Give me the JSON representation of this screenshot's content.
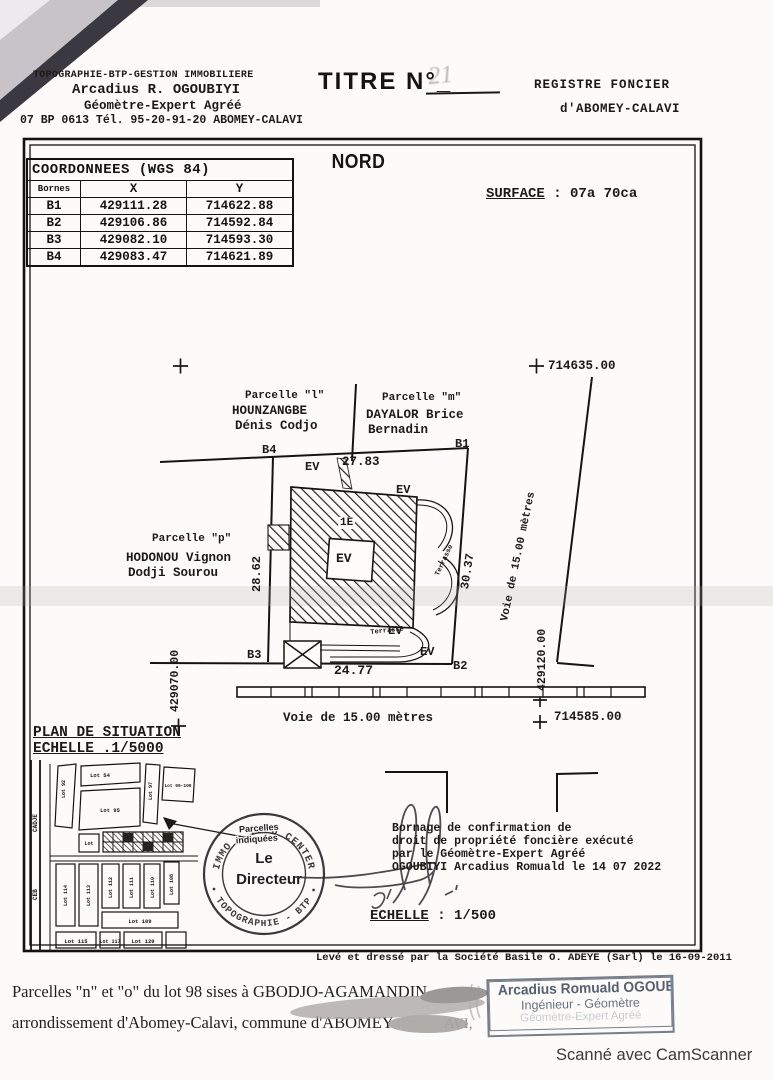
{
  "header": {
    "firm_line1": "TOPOGRAPHIE-BTP-GESTION IMMOBILIERE",
    "firm_line2": "Arcadius R. OGOUBIYI",
    "firm_line3": "Géomètre-Expert Agréé",
    "firm_line4": "07 BP 0613 Tél. 95-20-91-20 ABOMEY-CALAVI",
    "title_label": "TITRE N°_",
    "title_number": "21",
    "registre_line1": "REGISTRE  FONCIER",
    "registre_line2": "d'ABOMEY-CALAVI"
  },
  "plan_sheet": {
    "north": "NORD",
    "surface_label": "SURFACE",
    "surface_value": " : 07a 70ca",
    "coords_table": {
      "title": "COORDONNEES (WGS 84)",
      "headers": [
        "Bornes",
        "X",
        "Y"
      ],
      "rows": [
        {
          "borne": "B1",
          "x": "429111.28",
          "y": "714622.88"
        },
        {
          "borne": "B2",
          "x": "429106.86",
          "y": "714592.84"
        },
        {
          "borne": "B3",
          "x": "429082.10",
          "y": "714593.30"
        },
        {
          "borne": "B4",
          "x": "429083.47",
          "y": "714621.89"
        }
      ]
    },
    "grid_marks": {
      "top_y": "714635.00",
      "right_x": "429120.00",
      "bottom_y": "714585.00",
      "left_x": "429070.00"
    },
    "parcels": {
      "l": {
        "name": "Parcelle \"l\"",
        "owner1": "HOUNZANGBE",
        "owner2": "Dénis Codjo"
      },
      "m": {
        "name": "Parcelle \"m\"",
        "owner1": "DAYALOR Brice",
        "owner2": "Bernadin"
      },
      "p": {
        "name": "Parcelle \"p\"",
        "owner1": "HODONOU Vignon",
        "owner2": "Dodji Sourou"
      }
    },
    "bornes": {
      "b1": "B1",
      "b2": "B2",
      "b3": "B3",
      "b4": "B4"
    },
    "measurements": {
      "top": "27.83",
      "left": "28.62",
      "right": "30.37",
      "bottom": "24.77"
    },
    "roads": {
      "right": "Voie de 15.00 mètres",
      "bottom": "Voie de 15.00 mètres"
    },
    "labels": {
      "ev": "EV",
      "unit": "1E",
      "terrace": "Terrasse"
    },
    "situation": {
      "title": "PLAN DE SITUATION",
      "scale": "ECHELLE .1/5000",
      "road_left": "CADJE",
      "ceb": "CEB",
      "lots": [
        "Lot 92",
        "Lot 54",
        "Lot 95",
        "Lot 97",
        "Lot 99-100",
        "Lot",
        "Lot 114",
        "Lot 113",
        "Lot 112",
        "Lot 111",
        "Lot 110",
        "Lot 108",
        "Lot 109",
        "Lot 115",
        "Lot 117",
        "Lot 120"
      ]
    },
    "stamp_note": {
      "line1": "Parcelles",
      "line2": "indiquées"
    },
    "round_stamp": {
      "arc_top": "IMMO • TOPO CENTER",
      "arc_bottom": "• TOPOGRAPHIE - BTP •",
      "center1": "Le",
      "center2": "Directeur"
    },
    "bornage": [
      "Bornage de confirmation de",
      "droit de propriété foncière exécuté",
      "par le Géomètre-Expert Agréé",
      "OGOUBIYI Arcadius Romuald le 14 07 2022"
    ],
    "scale_label": "ECHELLE",
    "scale_value": " : 1/500",
    "credit": "Levé et dressé par la Société Basile O. ADEYE (Sarl) le 16-09-2011"
  },
  "footer": {
    "note_line1": "Parcelles \"n\" et \"o\" du lot 98 sises à GBODJO-AGAMANDIN,",
    "note_line2": "arrondissement d'Abomey-Calavi, commune d'ABOMEY",
    "note_line2_tail": "AVI,",
    "stamp": {
      "name": "Arcadius Romuald OGOUBIYI",
      "title": "Ingénieur - Géomètre",
      "line3": "Géomètre-Expert Agréé"
    }
  },
  "scan": {
    "camscanner": "Scanné avec CamScanner"
  }
}
